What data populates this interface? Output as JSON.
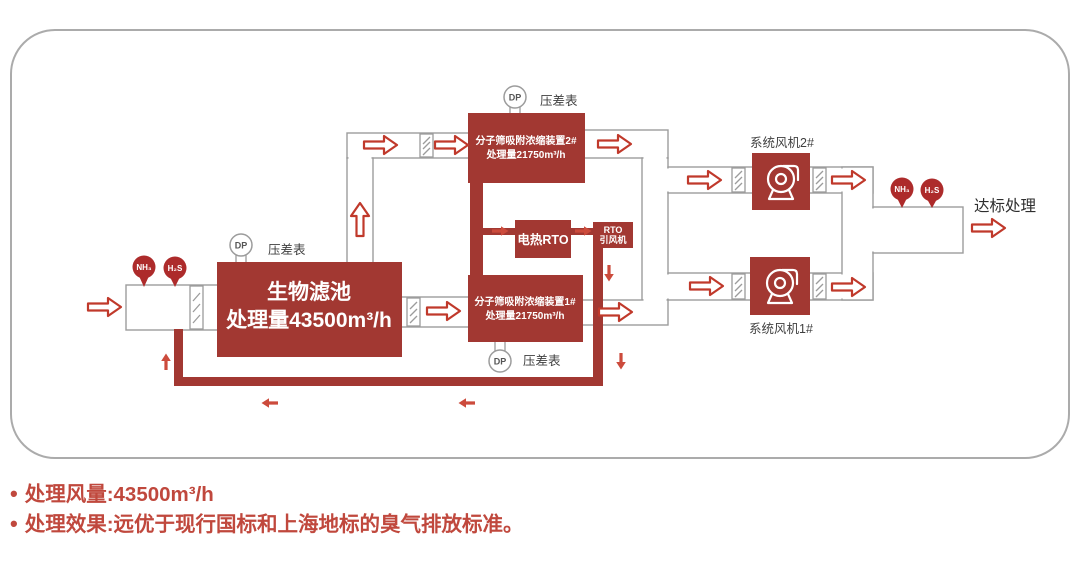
{
  "colors": {
    "box_red": "#A23832",
    "badge_red": "#AD2B2B",
    "flow_arrow_red": "#C0392B",
    "small_arrow_red": "#CC4B3C",
    "duct_gray": "#9C9C9C",
    "label_gray": "#3F3F3F",
    "footer_red": "#C0483D"
  },
  "diagram": {
    "inlet": {
      "nh3": "NH₃",
      "h2s": "H₂S"
    },
    "biofilter": {
      "name": "生物滤池",
      "capacity": "处理量43500m³/h"
    },
    "gauge1": {
      "abbr": "DP",
      "label": "压差表"
    },
    "gauge2": {
      "abbr": "DP",
      "label": "压差表"
    },
    "gauge3": {
      "abbr": "DP",
      "label": "压差表"
    },
    "device2": {
      "name": "分子筛吸附浓缩装置2#",
      "capacity": "处理量21750m³/h"
    },
    "device1": {
      "name": "分子筛吸附浓缩装置1#",
      "capacity": "处理量21750m³/h"
    },
    "rto": {
      "name": "电热RTO"
    },
    "rto_fan": {
      "name_line1": "RTO",
      "name_line2": "引风机"
    },
    "fan2": {
      "label": "系统风机2#"
    },
    "fan1": {
      "label": "系统风机1#"
    },
    "outlet": {
      "nh3": "NH₃",
      "h2s": "H₂S",
      "label": "达标处理"
    }
  },
  "footer": {
    "bullets": [
      {
        "text": "处理风量:43500m³/h"
      },
      {
        "text": "处理效果:远优于现行国标和上海地标的臭气排放标准。"
      }
    ]
  }
}
